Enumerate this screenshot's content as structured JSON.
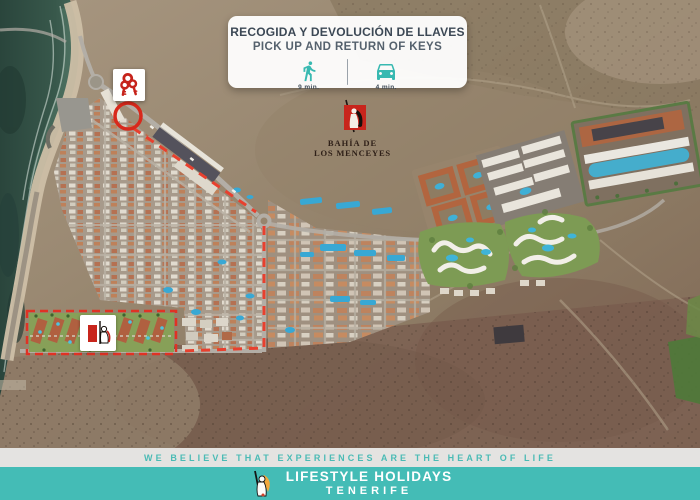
{
  "pickup_card": {
    "title_es": "RECOGIDA Y DEVOLUCIÓN DE LLAVES",
    "title_en": "PICK UP AND RETURN OF KEYS",
    "walk_icon": "walking-person-icon",
    "walk_duration": "9 min.",
    "drive_icon": "car-icon",
    "drive_duration": "4 min.",
    "icon_color": "#38b9b1"
  },
  "map": {
    "type": "satellite-aerial-photo",
    "resort_label_line1": "BAHÍA DE",
    "resort_label_line2": "LOS MENCEYES",
    "markers": {
      "keys_marker_icon": "red-keys-icon",
      "pickup_point_marker": "red-circle-outline",
      "route_style": "red-dashed-line",
      "resort_area_style": "red-dashed-rectangle",
      "resort_marker_icon": "bahia-de-los-menceyes-figure-logo"
    },
    "route_color": "#e8402e",
    "marker_red": "#c6231b"
  },
  "footer": {
    "tagline": "WE BELIEVE THAT EXPERIENCES ARE THE HEART OF LIFE",
    "brand_name": "LIFESTYLE HOLIDAYS",
    "brand_location": "TENERIFE",
    "tagline_color": "#4bbbb5",
    "band_color": "#44bcb6",
    "brand_logo_icon": "guanche-warrior-logo"
  }
}
